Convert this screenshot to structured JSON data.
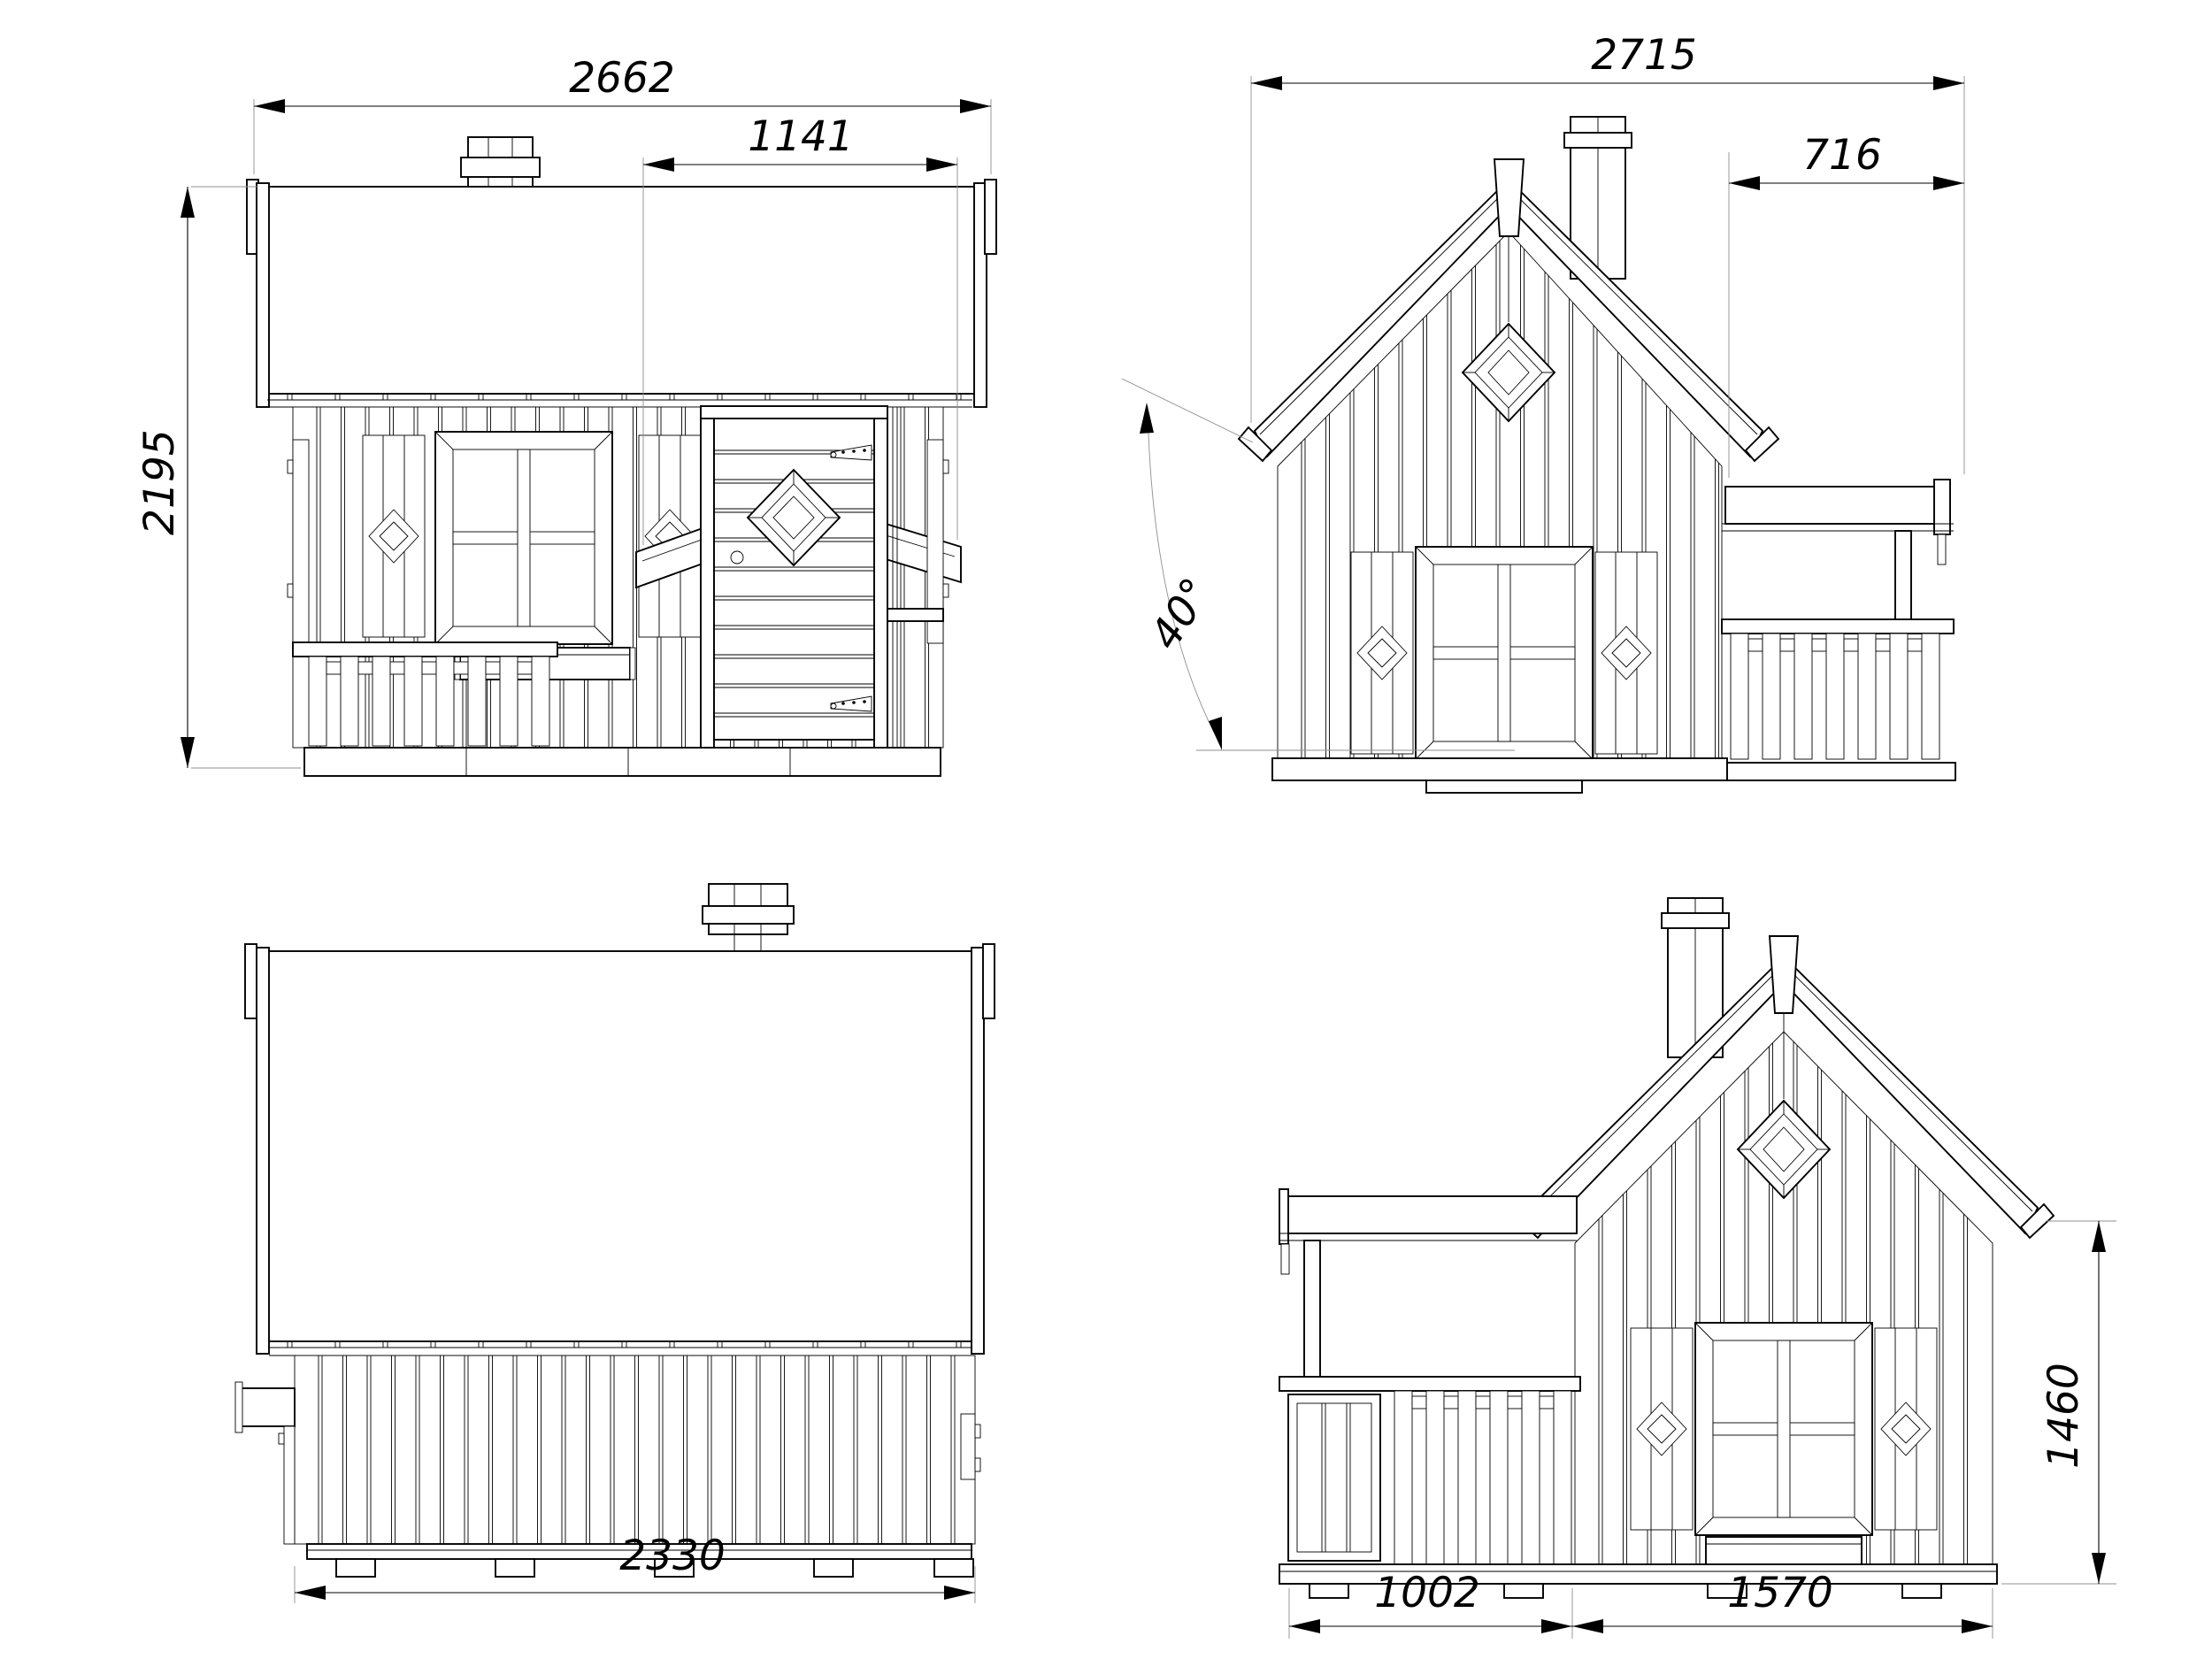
{
  "drawing": {
    "background": "#ffffff",
    "line_color": "#000000",
    "extension_line_color": "#8f8f8f",
    "views": {
      "front": {
        "dims": {
          "overall_width": "2662",
          "door_bay_width": "1141",
          "overall_height": "2195"
        }
      },
      "left_side": {
        "dims": {
          "overall_depth": "2715",
          "terrace_depth": "716",
          "roof_angle": "40°"
        }
      },
      "rear": {
        "dims": {
          "wall_width": "2330"
        }
      },
      "right_side": {
        "dims": {
          "terrace_width": "1002",
          "house_depth": "1570",
          "eave_height": "1460"
        }
      }
    }
  }
}
